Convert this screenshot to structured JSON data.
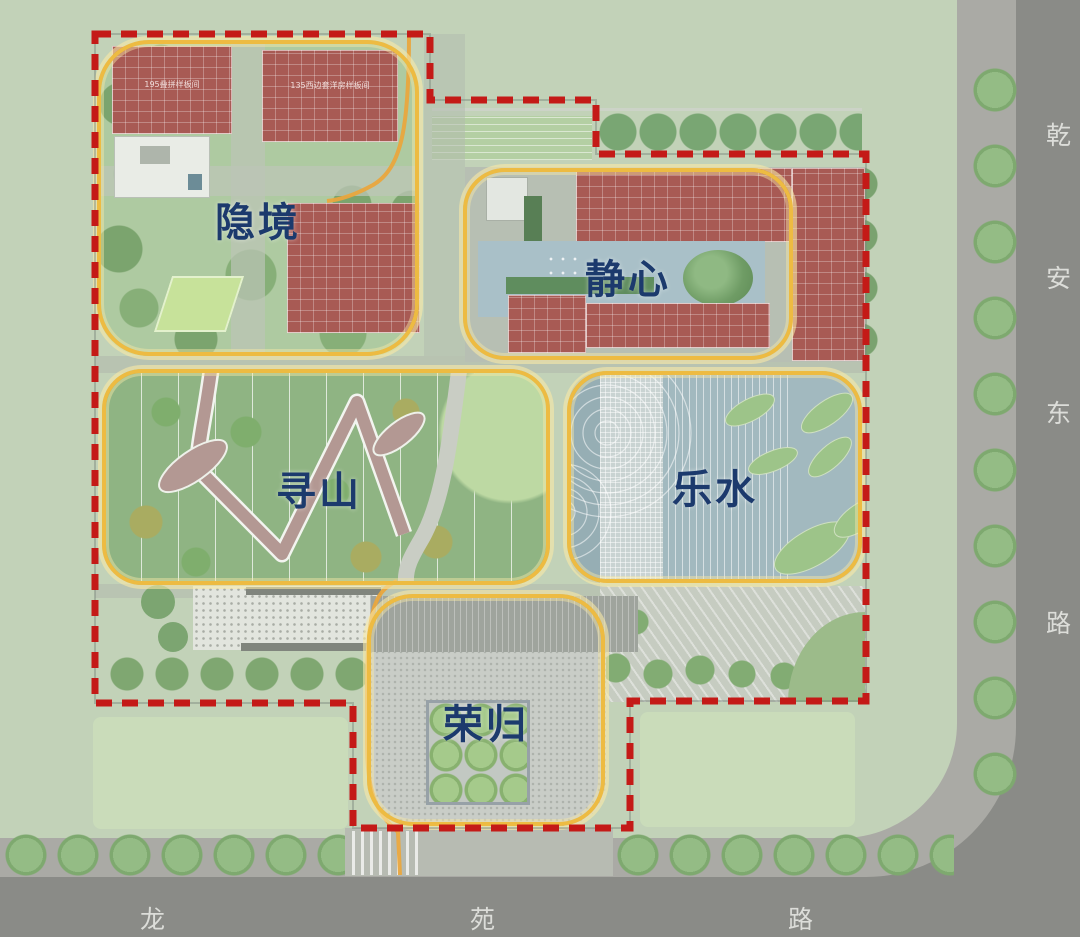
{
  "plan": {
    "zones": [
      {
        "id": "yinjing",
        "label": "隐境"
      },
      {
        "id": "jingxin",
        "label": "静心"
      },
      {
        "id": "xunshan",
        "label": "寻山"
      },
      {
        "id": "leshui",
        "label": "乐水"
      },
      {
        "id": "ronggui",
        "label": "荣归"
      }
    ],
    "building_labels": [
      {
        "text": "195叠拼样板间"
      },
      {
        "text": "135西边套洋房样板间"
      }
    ],
    "roads": {
      "east": {
        "name": "乾安东路",
        "chars": [
          "乾",
          "安",
          "东",
          "路"
        ]
      },
      "south": {
        "name": "龙苑路",
        "chars": [
          "龙",
          "苑",
          "路"
        ]
      }
    },
    "colors": {
      "site_boundary_dash": "#c41a17",
      "zone_outline_gold": "#edbb42",
      "zone_label_navy": "#1c3a6d",
      "building_red": "#a85a54",
      "water_blue": "#a2b9bf",
      "lawn_green": "#8fb483",
      "road_grey": "#8a8b87",
      "road_label_text": "#dcddd9"
    }
  }
}
